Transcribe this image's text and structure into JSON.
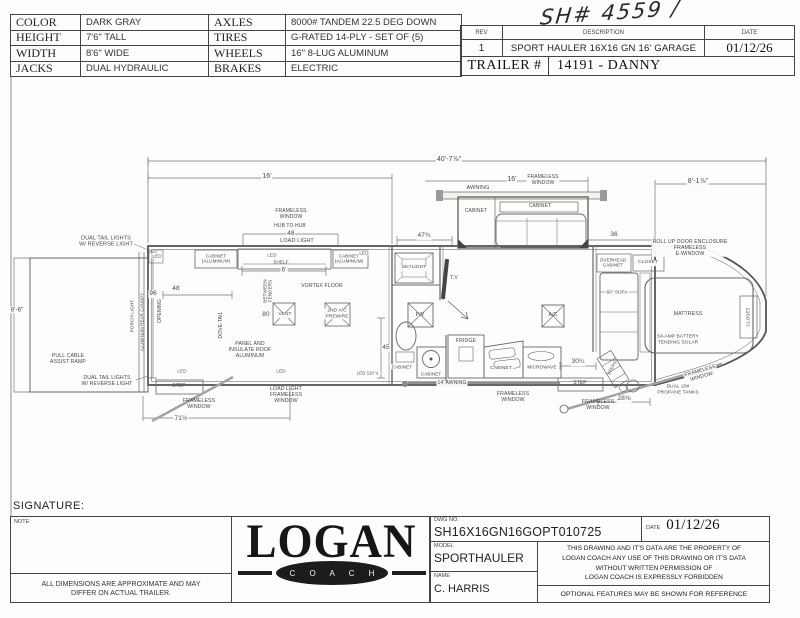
{
  "spec": {
    "rows": [
      {
        "c1": "COLOR",
        "v1": "DARK GRAY",
        "c2": "AXLES",
        "v2": "8000# TANDEM 22.5 DEG DOWN"
      },
      {
        "c1": "HEIGHT",
        "v1": "7'6\" TALL",
        "c2": "TIRES",
        "v2": "G-RATED 14-PLY - SET OF (5)"
      },
      {
        "c1": "WIDTH",
        "v1": "8'6\" WIDE",
        "c2": "WHEELS",
        "v2": "16\" 8-LUG ALUMINUM"
      },
      {
        "c1": "JACKS",
        "v1": "DUAL HYDRAULIC",
        "c2": "BRAKES",
        "v2": "ELECTRIC"
      }
    ]
  },
  "rev": {
    "rev_header": "REV",
    "description_header": "DESCRIPTION",
    "date_header": "DATE",
    "rev": "1",
    "description": "SPORT HAULER 16X16 GN 16' GARAGE",
    "date": "01/12/26",
    "trailer_label": "TRAILER #",
    "trailer_value": "14191 - DANNY"
  },
  "handwritten_note": "SH# 4559 /",
  "plan": {
    "labels": [
      {
        "n": "dim-overall-length",
        "t": "40'-7⅞\"",
        "x": 449,
        "y": 160,
        "s": 7,
        "bg": true
      },
      {
        "n": "dim-garage-length",
        "t": "16'",
        "x": 267,
        "y": 177,
        "s": 7,
        "bg": true
      },
      {
        "n": "dim-slide-window",
        "t": "16'",
        "x": 512,
        "y": 180,
        "s": 7,
        "bg": true
      },
      {
        "n": "label-frameless-window-slide",
        "t": "FRAMELESS\nWINDOW",
        "x": 543,
        "y": 181,
        "s": 5,
        "bg": true
      },
      {
        "n": "dim-nose-length",
        "t": "8'-1⅞\"",
        "x": 698,
        "y": 182,
        "s": 7,
        "bg": true
      },
      {
        "n": "label-awning-slide",
        "t": "AWNING",
        "x": 478,
        "y": 188,
        "s": 5.5,
        "bg": true
      },
      {
        "n": "label-frameless-window-hub",
        "t": "FRAMELESS\nWINDOW",
        "x": 291,
        "y": 215,
        "s": 5
      },
      {
        "n": "label-hub-to-hub",
        "t": "HUB TO HUB",
        "x": 290,
        "y": 227,
        "s": 5
      },
      {
        "n": "dim-hub-to-hub",
        "t": "48",
        "x": 291,
        "y": 234,
        "s": 6.5,
        "bg": true
      },
      {
        "n": "label-load-light-top",
        "t": "LOAD LIGHT",
        "x": 297,
        "y": 241,
        "s": 5.5,
        "bg": true
      },
      {
        "n": "label-dual-tail-lights-top",
        "t": "DUAL TAIL LIGHTS\nW/ REVERSE LIGHT",
        "x": 106,
        "y": 242,
        "s": 5.5
      },
      {
        "n": "label-led-1",
        "t": "LED",
        "x": 157,
        "y": 256,
        "s": 4.6,
        "bg": true
      },
      {
        "n": "label-cabinet-aluminum-1",
        "t": "CABINET\n(ALUMINUM)",
        "x": 216,
        "y": 259,
        "s": 4.6,
        "bg": true
      },
      {
        "n": "label-led-2",
        "t": "LED",
        "x": 272,
        "y": 255,
        "s": 4.6,
        "bg": true
      },
      {
        "n": "label-shelf",
        "t": "SHELF",
        "x": 281,
        "y": 262,
        "s": 4.6
      },
      {
        "n": "label-cabinet-aluminum-2",
        "t": "CABINET\n(ALUMINUM)",
        "x": 349,
        "y": 259,
        "s": 4.6,
        "bg": true
      },
      {
        "n": "label-led-3",
        "t": "LED",
        "x": 364,
        "y": 253,
        "s": 4.6,
        "bg": true
      },
      {
        "n": "dim-shelf-length",
        "t": "6'",
        "x": 284,
        "y": 271,
        "s": 6,
        "bg": true
      },
      {
        "n": "dim-opening-height",
        "t": "96",
        "x": 153,
        "y": 294,
        "s": 6.5,
        "bg": true
      },
      {
        "n": "dim-opening-width",
        "t": "48",
        "x": 176,
        "y": 289,
        "s": 6.5,
        "bg": true
      },
      {
        "n": "label-opening",
        "t": "OPENING",
        "x": 161,
        "y": 311,
        "s": 5,
        "r": -90
      },
      {
        "n": "label-porch-light",
        "t": "PORCH LIGHT",
        "x": 132,
        "y": 316,
        "s": 4.6,
        "r": -90
      },
      {
        "n": "label-aluminum-rear-canopy",
        "t": "ALUMINUM REAR CANOPY",
        "x": 142,
        "y": 322,
        "s": 4.4,
        "r": -90
      },
      {
        "n": "label-vortex-floor",
        "t": "VORTEX FLOOR",
        "x": 322,
        "y": 286,
        "s": 5.2
      },
      {
        "n": "label-dove-tail",
        "t": "DOVE-TAIL",
        "x": 222,
        "y": 325,
        "s": 5,
        "r": -90
      },
      {
        "n": "label-between-fenders",
        "t": "BETWEEN\nFENDERS",
        "x": 268,
        "y": 291,
        "s": 4.6,
        "r": -90
      },
      {
        "n": "dim-vent",
        "t": "80",
        "x": 266,
        "y": 315,
        "s": 6.5,
        "bg": true
      },
      {
        "n": "label-vent",
        "t": "VENT",
        "x": 285,
        "y": 315,
        "s": 4.8,
        "bg": true
      },
      {
        "n": "label-2nd-ac-prewire",
        "t": "2ND A/C\nPREWIRE",
        "x": 337,
        "y": 314,
        "s": 4.8,
        "bg": true
      },
      {
        "n": "label-panel-insulate-roof",
        "t": "PANEL AND\nINSULATE ROOF\nALUMINUM",
        "x": 250,
        "y": 350,
        "s": 5.2
      },
      {
        "n": "dim-45",
        "t": "45",
        "x": 386,
        "y": 348,
        "s": 6.5,
        "bg": true
      },
      {
        "n": "label-led-4",
        "t": "LED",
        "x": 182,
        "y": 371,
        "s": 4.6,
        "bg": true
      },
      {
        "n": "label-led-5",
        "t": "LED",
        "x": 281,
        "y": 371,
        "s": 4.6,
        "bg": true
      },
      {
        "n": "label-led-110v",
        "t": "LED 110 V.",
        "x": 368,
        "y": 373,
        "s": 4.4,
        "bg": true
      },
      {
        "n": "label-pull-cable-assist-ramp",
        "t": "PULL CABLE\nASSIST RAMP",
        "x": 68,
        "y": 359,
        "s": 5.2
      },
      {
        "n": "label-dual-tail-lights-bottom",
        "t": "DUAL TAIL LIGHTS\nW/ REVERSE LIGHT",
        "x": 107,
        "y": 381,
        "s": 5.2
      },
      {
        "n": "dim-ramp-height",
        "t": "8'-6\"",
        "x": 17,
        "y": 310,
        "s": 6.2,
        "bg": true
      },
      {
        "n": "label-step-left",
        "t": "STEP",
        "x": 179,
        "y": 387,
        "s": 5
      },
      {
        "n": "label-frameless-window-left",
        "t": "FRAMELESS\nWINDOW",
        "x": 199,
        "y": 404,
        "s": 5.2
      },
      {
        "n": "dim-dovetail-length",
        "t": "71½",
        "x": 181,
        "y": 419,
        "s": 6.5,
        "bg": true
      },
      {
        "n": "label-load-light-bottom",
        "t": "LOAD LIGHT\nFRAMELESS\nWINDOW",
        "x": 286,
        "y": 395,
        "s": 5.2
      },
      {
        "n": "label-skylight",
        "t": "SKYLIGHT",
        "x": 414,
        "y": 268,
        "s": 4.8,
        "bg": true
      },
      {
        "n": "label-tv",
        "t": "T.V",
        "x": 454,
        "y": 279,
        "s": 5
      },
      {
        "n": "label-power-vent",
        "t": "P/V",
        "x": 420,
        "y": 315,
        "s": 5.2
      },
      {
        "n": "label-cabinet-bath",
        "t": "CABINET",
        "x": 402,
        "y": 367,
        "s": 4.6,
        "bg": true
      },
      {
        "n": "label-cabinet-sink",
        "t": "CABINET",
        "x": 431,
        "y": 374,
        "s": 4.6,
        "bg": true
      },
      {
        "n": "label-fridge",
        "t": "FRIDGE",
        "x": 466,
        "y": 341,
        "s": 5.2
      },
      {
        "n": "label-cabinet-kitchen",
        "t": "CABINET",
        "x": 501,
        "y": 369,
        "s": 4.8,
        "bg": true
      },
      {
        "n": "label-microwave",
        "t": "MICROWAVE",
        "x": 542,
        "y": 367,
        "s": 4.6,
        "bg": true
      },
      {
        "n": "label-ac",
        "t": "A/C",
        "x": 553,
        "y": 316,
        "s": 5
      },
      {
        "n": "label-awning-14",
        "t": "14' AWNING",
        "x": 452,
        "y": 384,
        "s": 5,
        "bg": true
      },
      {
        "n": "label-frameless-window-mid",
        "t": "FRAMELESS\nWINDOW",
        "x": 513,
        "y": 397,
        "s": 5.2
      },
      {
        "n": "dim-30",
        "t": "30¼",
        "x": 578,
        "y": 362,
        "s": 6.5,
        "bg": true
      },
      {
        "n": "label-step-right",
        "t": "STEP",
        "x": 580,
        "y": 384,
        "s": 5
      },
      {
        "n": "label-frameless-window-door",
        "t": "FRAMELESS\nWINDOW",
        "x": 598,
        "y": 405,
        "s": 5.2
      },
      {
        "n": "dim-28",
        "t": "28⅛",
        "x": 624,
        "y": 399,
        "s": 6.5,
        "bg": true
      },
      {
        "n": "dim-47",
        "t": "47¾",
        "x": 424,
        "y": 236,
        "s": 6.5,
        "bg": true
      },
      {
        "n": "label-cabinet-slide",
        "t": "CABINET",
        "x": 476,
        "y": 212,
        "s": 5,
        "bg": true
      },
      {
        "n": "label-cabinet-slide-top",
        "t": "CABINET",
        "x": 540,
        "y": 207,
        "s": 5,
        "bg": true
      },
      {
        "n": "dim-36",
        "t": "36",
        "x": 614,
        "y": 235,
        "s": 6.5,
        "bg": true
      },
      {
        "n": "label-rollup-door",
        "t": "ROLL UP DOOR ENCLOSURE\nFRAMELESS\nE-WINDOW",
        "x": 690,
        "y": 248,
        "s": 5.2,
        "bg": true
      },
      {
        "n": "label-overhead-cabinet",
        "t": "OVERHEAD\nCABINET",
        "x": 613,
        "y": 263,
        "s": 4.6,
        "bg": true
      },
      {
        "n": "label-closet-top",
        "t": "CLOSET",
        "x": 648,
        "y": 263,
        "s": 4.8,
        "bg": true
      },
      {
        "n": "label-sofa-60",
        "t": "60\" SOFA",
        "x": 617,
        "y": 292,
        "s": 4.6,
        "bg": true
      },
      {
        "n": "label-mattress",
        "t": "MATTRESS",
        "x": 688,
        "y": 314,
        "s": 5.2
      },
      {
        "n": "label-battery-solar",
        "t": "50-AMP BATTERY\nTENDING SOLAR",
        "x": 678,
        "y": 340,
        "s": 4.8
      },
      {
        "n": "label-closet-right",
        "t": "CLOSET",
        "x": 748,
        "y": 317,
        "s": 4.6,
        "r": -90
      },
      {
        "n": "label-steps",
        "t": "STEPS",
        "x": 612,
        "y": 368,
        "s": 4.4,
        "r": -62
      },
      {
        "n": "label-propane-tanks",
        "t": "DUAL 20#\nPROPANE TANKS",
        "x": 678,
        "y": 390,
        "s": 4.8
      },
      {
        "n": "label-frameless-window-nose",
        "t": "FRAMELESS\nWINDOW",
        "x": 701,
        "y": 374,
        "s": 5.2,
        "r": -16,
        "bg": true
      }
    ]
  },
  "footer": {
    "signature_label": "SIGNATURE:",
    "note_label": "NOTE:",
    "disclaimer": "ALL DIMENSIONS ARE APPROXIMATE AND MAY\nDIFFER ON ACTUAL TRAILER.",
    "logo_main": "LOGAN",
    "logo_sub": "C O A C H",
    "dwg_label": "DWG  NO.",
    "dwg_no": "SH16X16GN16GOPT010725",
    "date_label": "DATE",
    "date_value": "01/12/26",
    "model_label": "MODEL",
    "model_value": "SPORTHAULER",
    "name_label": "NAME",
    "name_value": "C. HARRIS",
    "legal": "THIS DRAWING AND IT'S DATA ARE THE PROPERTY OF\nLOGAN COACH ANY USE OF THIS DRAWING OR IT'S DATA\nWITHOUT WRITTEN PERMISSION OF\nLOGAN COACH IS EXPRESSLY FORBIDDEN",
    "optional": "OPTIONAL FEATURES MAY BE SHOWN FOR REFERENCE"
  }
}
